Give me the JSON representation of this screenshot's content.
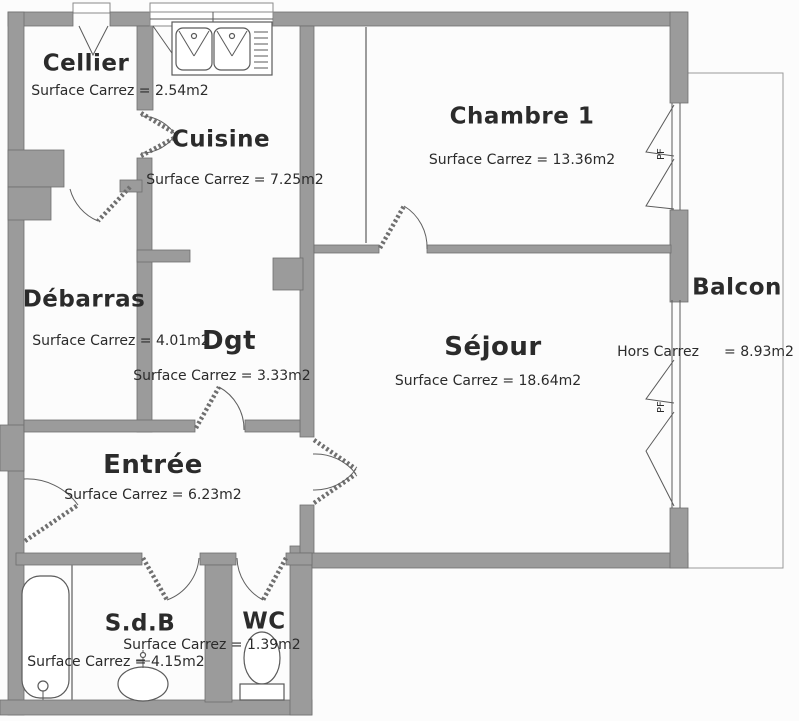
{
  "plan": {
    "background": "#fcfcfc",
    "wall_color": "#9b9b9b",
    "line_color": "#5f5f5f",
    "text_color": "#2b2b2b"
  },
  "rooms": {
    "cellier": {
      "name": "Cellier",
      "area": "Surface Carrez = 2.54m2"
    },
    "cuisine": {
      "name": "Cuisine",
      "area": "Surface Carrez = 7.25m2"
    },
    "chambre1": {
      "name": "Chambre 1",
      "area": "Surface Carrez = 13.36m2"
    },
    "debarras": {
      "name": "Débarras",
      "area": "Surface Carrez = 4.01m2"
    },
    "dgt": {
      "name": "Dgt",
      "area": "Surface Carrez = 3.33m2"
    },
    "sejour": {
      "name": "Séjour",
      "area": "Surface Carrez = 18.64m2"
    },
    "balcon": {
      "name": "Balcon",
      "area_label": "Hors Carrez",
      "area_value": "= 8.93m2"
    },
    "entree": {
      "name": "Entrée",
      "area": "Surface Carrez = 6.23m2"
    },
    "sdb": {
      "name": "S.d.B",
      "area": "Surface Carrez = 4.15m2"
    },
    "wc": {
      "name": "WC",
      "area": "Surface Carrez = 1.39m2"
    }
  },
  "windows": {
    "pf_label": "PF"
  }
}
